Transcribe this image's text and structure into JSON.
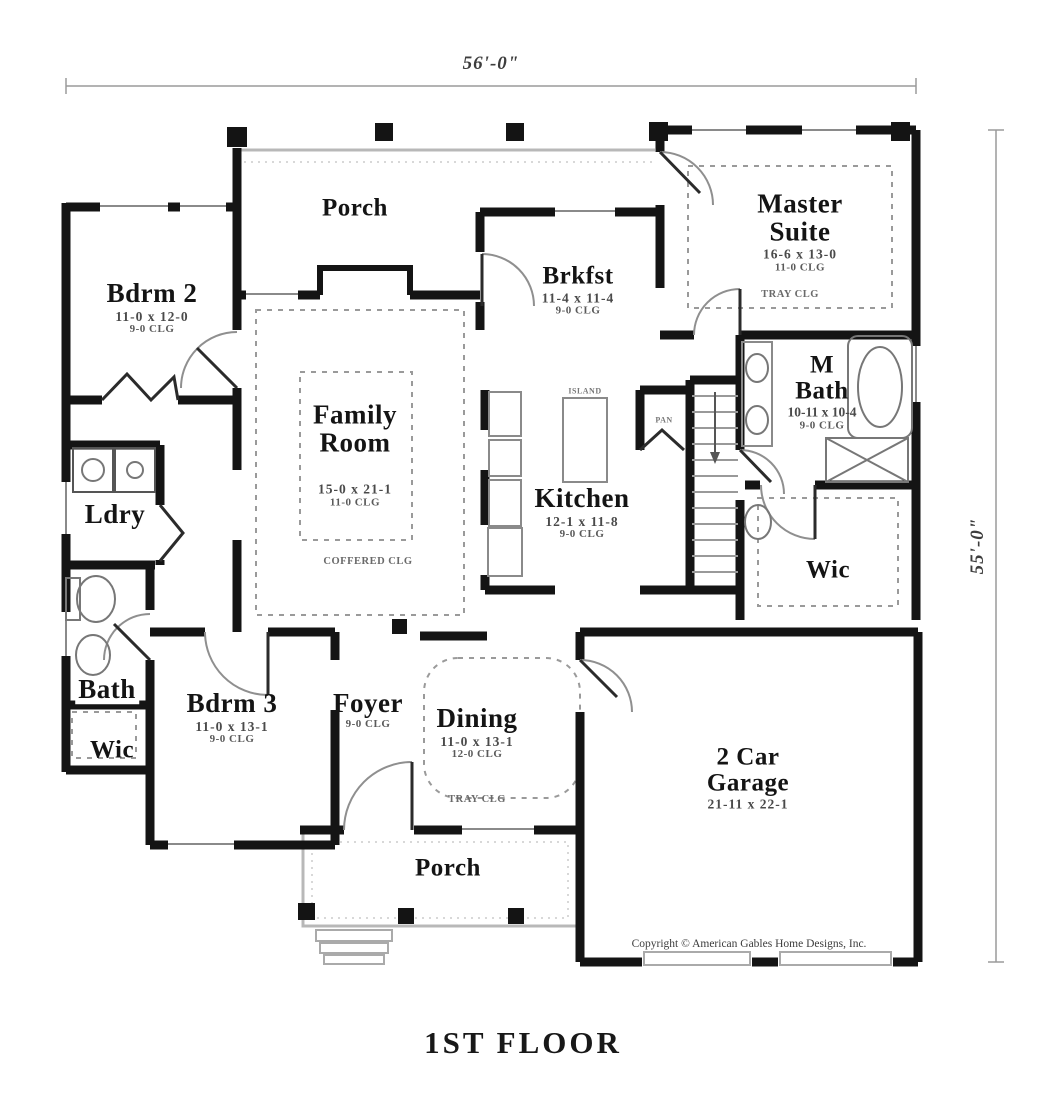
{
  "title": "1ST FLOOR",
  "dimensions": {
    "width": "56'-0\"",
    "height": "55'-0\""
  },
  "copyright": "Copyright © American Gables Home Designs, Inc.",
  "colors": {
    "wall": "#141414",
    "light_line": "#b8b8b8",
    "dash_line": "#9a9a9a"
  },
  "rooms": [
    {
      "name": "Porch"
    },
    {
      "name": "Bdrm 2",
      "size": "11-0 x 12-0",
      "ceiling": "9-0 CLG"
    },
    {
      "name": "Master Suite",
      "size": "16-6 x 13-0",
      "ceiling": "11-0 CLG",
      "ceiling2": "TRAY CLG"
    },
    {
      "name": "Brkfst",
      "size": "11-4 x 11-4",
      "ceiling": "9-0 CLG"
    },
    {
      "name": "Family Room",
      "size": "15-0 x 21-1",
      "ceiling": "11-0 CLG",
      "ceiling2": "COFFERED CLG"
    },
    {
      "name": "Kitchen",
      "size": "12-1 x 11-8",
      "ceiling": "9-0 CLG"
    },
    {
      "name": "M Bath",
      "size": "10-11 x 10-4",
      "ceiling": "9-0 CLG"
    },
    {
      "name": "Ldry"
    },
    {
      "name": "Wic"
    },
    {
      "name": "Bath"
    },
    {
      "name": "Wic"
    },
    {
      "name": "Bdrm 3",
      "size": "11-0 x 13-1",
      "ceiling": "9-0 CLG"
    },
    {
      "name": "Foyer",
      "ceiling": "9-0 CLG"
    },
    {
      "name": "Dining",
      "size": "11-0 x 13-1",
      "ceiling": "12-0 CLG",
      "ceiling2": "TRAY CLG"
    },
    {
      "name": "2 Car Garage",
      "size": "21-11 x 22-1"
    },
    {
      "name": "Porch"
    }
  ],
  "annotations": {
    "island": "ISLAND",
    "pantry": "PAN"
  }
}
